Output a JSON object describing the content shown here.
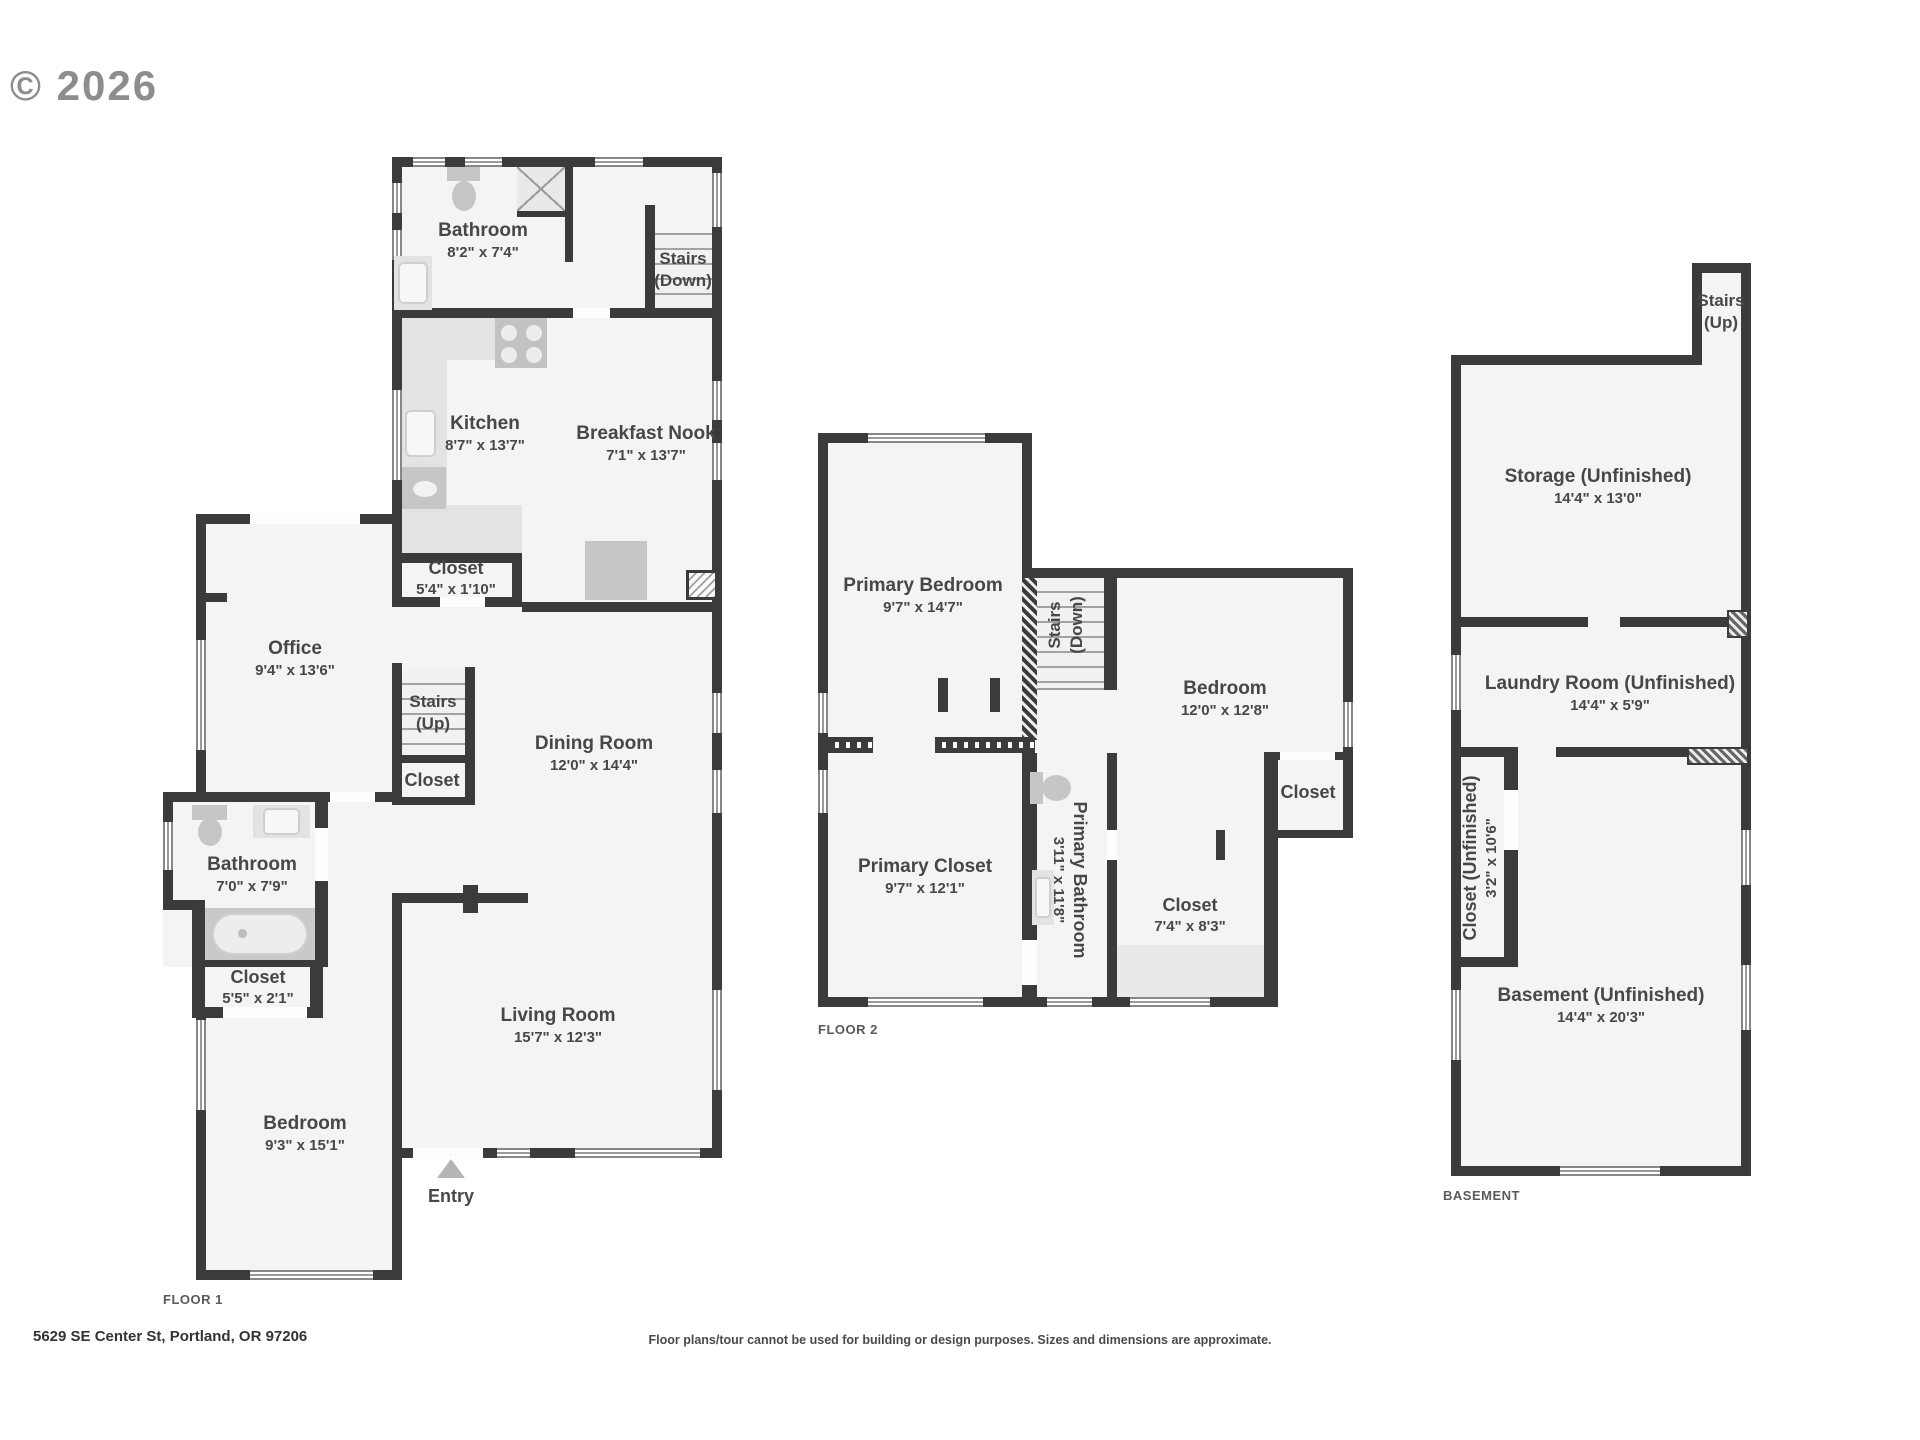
{
  "watermark": "© 2026",
  "floor1": {
    "label": "FLOOR 1",
    "bathroom_top": {
      "name": "Bathroom",
      "dims": "8'2\" x 7'4\""
    },
    "stairs_down": {
      "name": "Stairs",
      "dir": "(Down)"
    },
    "kitchen": {
      "name": "Kitchen",
      "dims": "8'7\" x 13'7\""
    },
    "breakfast_nook": {
      "name": "Breakfast Nook",
      "dims": "7'1\" x 13'7\""
    },
    "closet_kitchen": {
      "name": "Closet",
      "dims": "5'4\" x 1'10\""
    },
    "office": {
      "name": "Office",
      "dims": "9'4\" x 13'6\""
    },
    "stairs_up": {
      "name": "Stairs",
      "dir": "(Up)"
    },
    "closet_hall": {
      "name": "Closet"
    },
    "dining_room": {
      "name": "Dining Room",
      "dims": "12'0\" x 14'4\""
    },
    "bathroom": {
      "name": "Bathroom",
      "dims": "7'0\" x 7'9\""
    },
    "closet_bath": {
      "name": "Closet",
      "dims": "5'5\" x 2'1\""
    },
    "bedroom": {
      "name": "Bedroom",
      "dims": "9'3\" x 15'1\""
    },
    "living_room": {
      "name": "Living Room",
      "dims": "15'7\" x 12'3\""
    },
    "entry": {
      "name": "Entry"
    }
  },
  "floor2": {
    "label": "FLOOR 2",
    "primary_bedroom": {
      "name": "Primary Bedroom",
      "dims": "9'7\" x 14'7\""
    },
    "stairs_down": {
      "name": "Stairs",
      "dir": "(Down)"
    },
    "bedroom": {
      "name": "Bedroom",
      "dims": "12'0\" x 12'8\""
    },
    "closet_bedroom": {
      "name": "Closet"
    },
    "primary_closet": {
      "name": "Primary Closet",
      "dims": "9'7\" x 12'1\""
    },
    "primary_bathroom": {
      "name": "Primary Bathroom",
      "dims": "3'11\" x 11'8\""
    },
    "closet": {
      "name": "Closet",
      "dims": "7'4\" x 8'3\""
    }
  },
  "basement": {
    "label": "BASEMENT",
    "stairs_up": {
      "name": "Stairs",
      "dir": "(Up)"
    },
    "storage": {
      "name": "Storage (Unfinished)",
      "dims": "14'4\" x 13'0\""
    },
    "laundry": {
      "name": "Laundry Room (Unfinished)",
      "dims": "14'4\" x 5'9\""
    },
    "closet": {
      "name": "Closet (Unfinished)",
      "dims": "3'2\" x 10'6\""
    },
    "basement_room": {
      "name": "Basement (Unfinished)",
      "dims": "14'4\" x 20'3\""
    }
  },
  "footer": {
    "address": "5629 SE Center St, Portland, OR 97206",
    "disclaimer": "Floor plans/tour cannot be used for building or design purposes. Sizes and dimensions are approximate."
  },
  "colors": {
    "wall": "#3b3b3b",
    "room": "#f4f4f4",
    "fixture": "#c6c6c6",
    "text": "#474747"
  }
}
